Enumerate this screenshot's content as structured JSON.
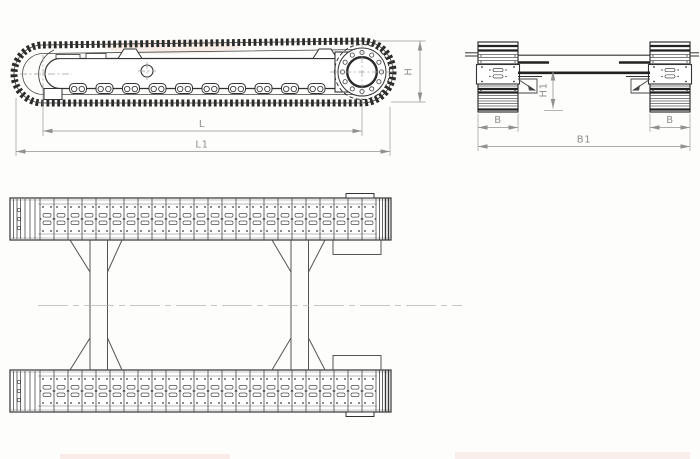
{
  "drawing": {
    "views": {
      "side_view_name": "side-elevation",
      "front_view_name": "end-elevation",
      "plan_view_name": "plan"
    }
  },
  "dimensions": {
    "side_view": {
      "l": "L",
      "l1": "L1",
      "h": "H"
    },
    "front_view": {
      "b_left": "B",
      "b_right": "B",
      "b1": "B1",
      "h1": "H1"
    }
  },
  "colors": {
    "line_color": "#333333",
    "dimension_color": "#8f8f8f",
    "background": "#fdfdfb"
  }
}
